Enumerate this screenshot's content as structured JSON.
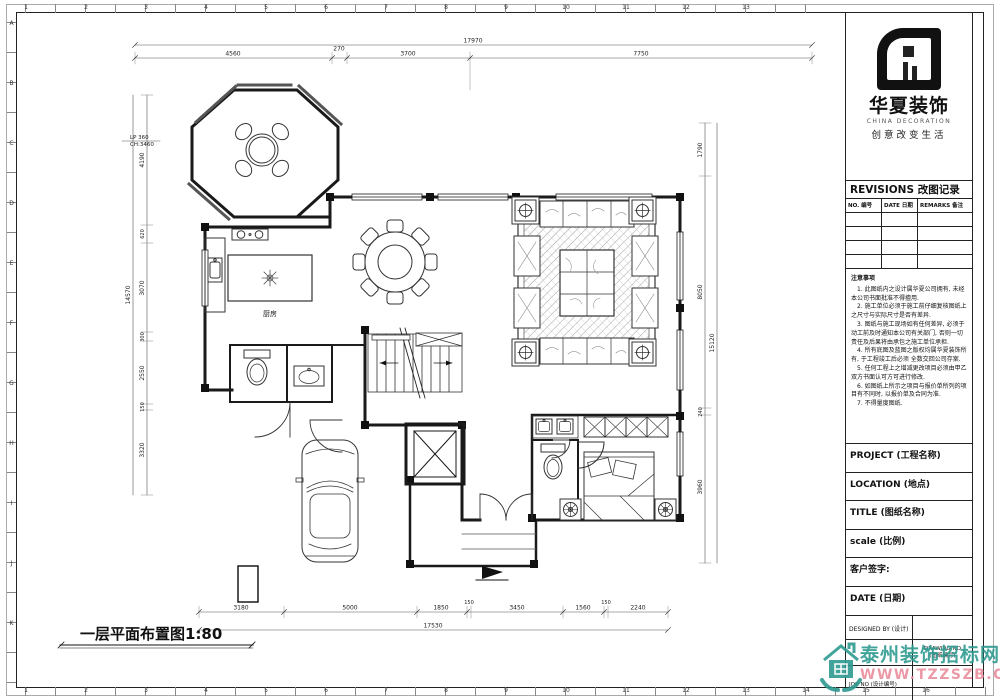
{
  "sheet": {
    "ruler_top_numbers": [
      "1",
      "2",
      "3",
      "4",
      "5",
      "6",
      "7",
      "8",
      "9",
      "10",
      "11",
      "12",
      "13"
    ],
    "ruler_bottom_numbers": [
      "1",
      "2",
      "3",
      "4",
      "5",
      "6",
      "7",
      "8",
      "9",
      "10",
      "11",
      "12",
      "13",
      "14",
      "15",
      "16"
    ],
    "ruler_left_letters": [
      "A",
      "B",
      "C",
      "D",
      "E",
      "F",
      "G",
      "H",
      "I",
      "J",
      "K"
    ]
  },
  "plan": {
    "title": "一层平面布置图1:80",
    "level_annotation_line1": "LP 360",
    "level_annotation_line2": "CH:3460",
    "room_labels": {
      "kitchen": "厨房"
    },
    "dims": {
      "top_total": "17970",
      "top_segments": [
        "4560",
        "270",
        "3700",
        "7750"
      ],
      "bottom_segments": [
        "3180",
        "5000",
        "1850",
        "150",
        "3450",
        "1560",
        "150",
        "2240"
      ],
      "bottom_total": "17530",
      "left_segments": [
        "4190",
        "620",
        "3070",
        "300",
        "2550",
        "150",
        "3320"
      ],
      "left_total": "14570",
      "right_segments": [
        "1790",
        "8050",
        "240",
        "3960"
      ],
      "right_total": "15120"
    }
  },
  "title_block": {
    "logo": {
      "name_cn": "华夏装饰",
      "name_en": "CHINA DECORATION",
      "slogan": "创意改变生活"
    },
    "revisions_title": "REVISIONS 改图记录",
    "revisions_columns": [
      "NO. 编号",
      "DATE 日期",
      "REMARKS 备注"
    ],
    "revision_empty_rows": [
      "",
      "",
      "",
      ""
    ],
    "notes_title": "注意事项",
    "notes": [
      "1. 此图纸内之设计属华夏公司拥有, 未经本公司书面批准不得擅用.",
      "2. 施工单位必须于施工前仔细复核图纸上之尺寸与实际尺寸是否有差异.",
      "3. 图纸与施工现场如有任何差异, 必须于动工前及时通知本公司有关部门, 否则一切责任及后果将由承包之施工单位承担.",
      "4. 所有底图及蓝图之版权均属华夏装饰所有, 于工程竣工后必须  全数交回公司存案.",
      "5. 任何工程上之增减更改项目必须由甲乙双方书面认可方可进行修改.",
      "6. 如图纸上所示之项目与报价单所列的项目有不同时, 以报价单及合同为准.",
      "7. 不得量度图纸."
    ],
    "fields": [
      "PROJECT (工程名称)",
      "LOCATION (地点)",
      "TITLE (图纸名称)",
      "scale  (比例)",
      "客户签字:",
      "DATE (日期)"
    ],
    "designed_by": "DESIGNED BY (设计)",
    "drawing_no_line1": "DRAWING NO",
    "drawing_no_line2": "(图纸编号)",
    "job_no": "JOB NO (设计编号)"
  },
  "watermark": {
    "site_name": "泰州装饰招标网",
    "site_url": "WWW.TZZSZB.COM"
  },
  "colors": {
    "line": "#1a1a1a",
    "watermark_teal": "#2e9a91",
    "watermark_pink": "#ea8f9e"
  }
}
